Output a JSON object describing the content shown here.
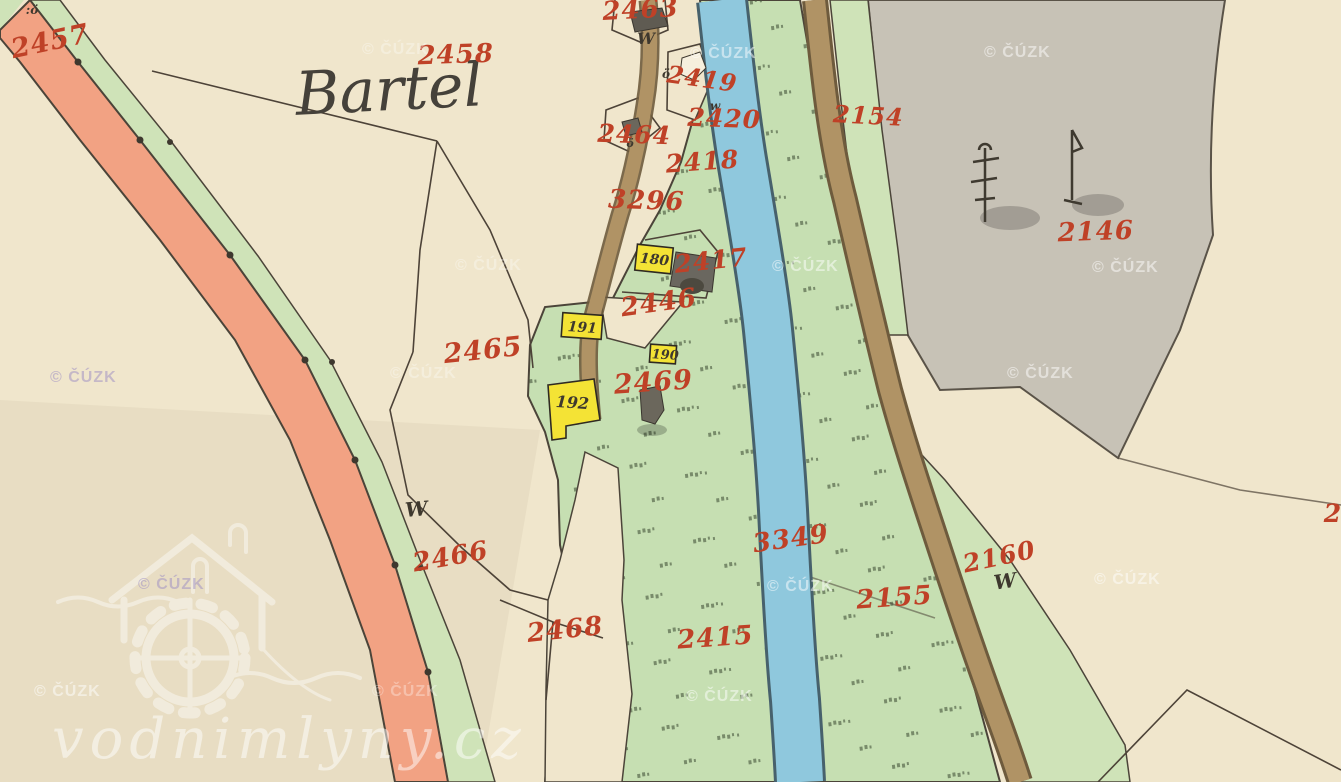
{
  "map": {
    "title": "Bartel",
    "labels": {
      "p2457": "2457",
      "p2458": "2458",
      "p2463": "2463",
      "p2419": "2419",
      "p2420": "2420",
      "p2154": "2154",
      "p2464": "2464",
      "p2418": "2418",
      "p3296": "3296",
      "p2417": "2417",
      "p2446": "2446",
      "p2465": "2465",
      "p2469": "2469",
      "p2146": "2146",
      "p3349": "3349",
      "p2160": "2160",
      "p2155": "2155",
      "p2466": "2466",
      "p2468": "2468",
      "p2415": "2415",
      "p_edge_partial": "2"
    },
    "buildings": {
      "b180": "180",
      "b191": "191",
      "b190": "190",
      "b192": "192"
    },
    "symbols": {
      "meadow_w": "W",
      "meadow_w_small": "w",
      "house_o": "ö",
      "house_o_colon": ":ö"
    },
    "watermarks": {
      "copyright": "© ČÚZK",
      "site": "vodnimlyny.cz"
    },
    "colors": {
      "paper": "#f0e6cc",
      "paper_shade": "#e9dfc5",
      "salmon_road": "#f2a283",
      "green_strip": "#cfe3b8",
      "meadow": "#c6dfb2",
      "river": "#8fc8dd",
      "river_edge": "#47616c",
      "road_brown": "#b09365",
      "road_edge": "#6e5b3d",
      "forest_gray": "#c7c2b6",
      "building_yellow": "#f4e335",
      "label_red": "#bf4127",
      "ink": "#3e382e"
    }
  }
}
